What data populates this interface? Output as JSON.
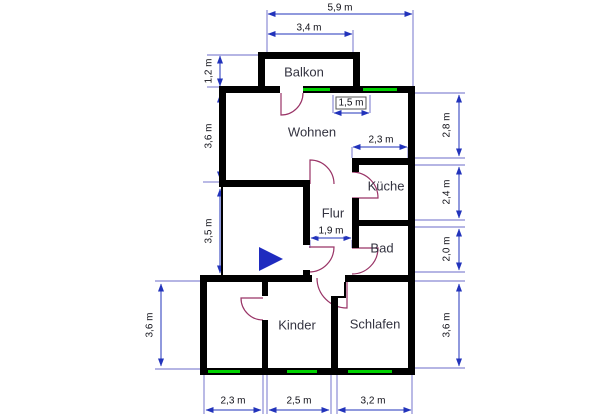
{
  "rooms": {
    "balkon": "Balkon",
    "wohnen": "Wohnen",
    "kueche": "Küche",
    "flur": "Flur",
    "bad": "Bad",
    "kinder": "Kinder",
    "schlafen": "Schlafen"
  },
  "dimensions": {
    "top_total": "5,9 m",
    "balkon_width": "3,4 m",
    "balkon_depth": "1,2 m",
    "window_width": "1,5 m",
    "kueche_width": "2,3 m",
    "flur_width": "1,9 m",
    "left_wohnen_height": "3,6 m",
    "left_middle_height": "3,5 m",
    "left_bottom_height": "3,6 m",
    "right_top_height": "2,8 m",
    "right_kueche_height": "2,4 m",
    "right_bad_height": "2,0 m",
    "right_schlafen_height": "3,6 m",
    "bottom_left_width": "2,3 m",
    "bottom_kinder_width": "2,5 m",
    "bottom_schlafen_width": "3,2 m"
  },
  "colors": {
    "wall": "#000000",
    "window": "#00d200",
    "dimension_line": "#2233bb",
    "door": "#993366",
    "direction_marker": "#1f2bbf",
    "background": "#ffffff"
  }
}
